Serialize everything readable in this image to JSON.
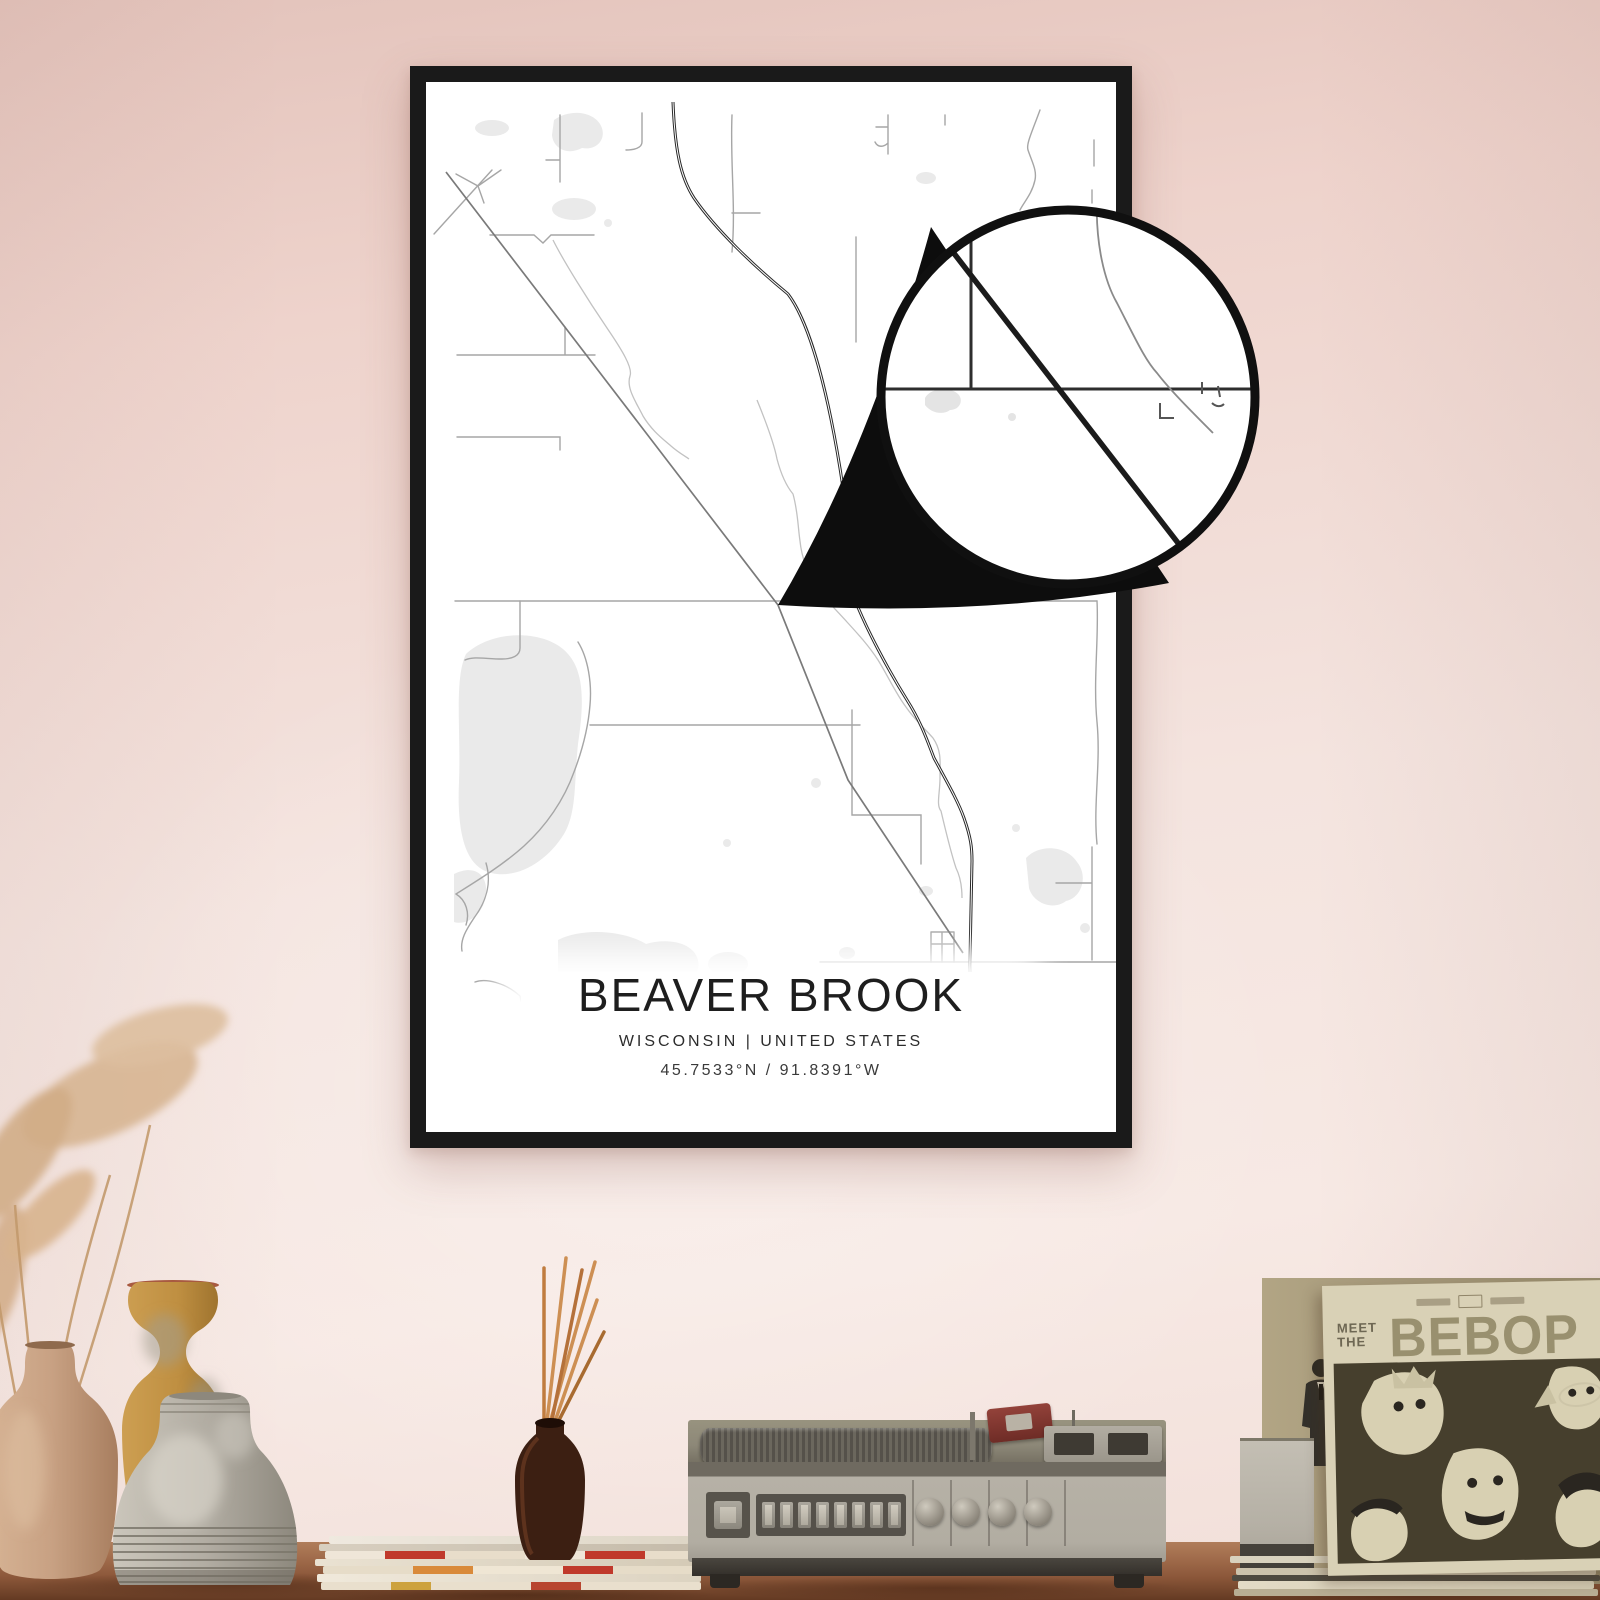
{
  "poster": {
    "title": "BEAVER BROOK",
    "subtitle": "WISCONSIN | UNITED STATES",
    "coordinates": "45.7533°N / 91.8391°W"
  },
  "record_sleeve": {
    "header_line1": "MEET",
    "header_line2": "THE",
    "title": "BEBOP"
  },
  "colors": {
    "wall_top": "#e3c3bb",
    "wall_mid": "#f4e4df",
    "wall_bottom": "#f1ded8",
    "frame": "#1a1a1a",
    "poster_background": "#ffffff",
    "road_minor": "#a6a6a6",
    "road_medium": "#7a7a7a",
    "road_major": "#282828",
    "river": "#c2c2c2",
    "water": "#eaeaea",
    "shelf_wood": "#9d6848",
    "player_body": "#b2ada2",
    "cartridge_red": "#8d3a32",
    "sleeve_cream": "#d9d1b6",
    "sleeve_art": "#463f2d",
    "record_teal": "#5d9598",
    "incense_stick": "#cd8f53",
    "vase_tan": "#c8a183",
    "vase_ochre": "#bf8f41",
    "vase_gray": "#b2ada3"
  }
}
